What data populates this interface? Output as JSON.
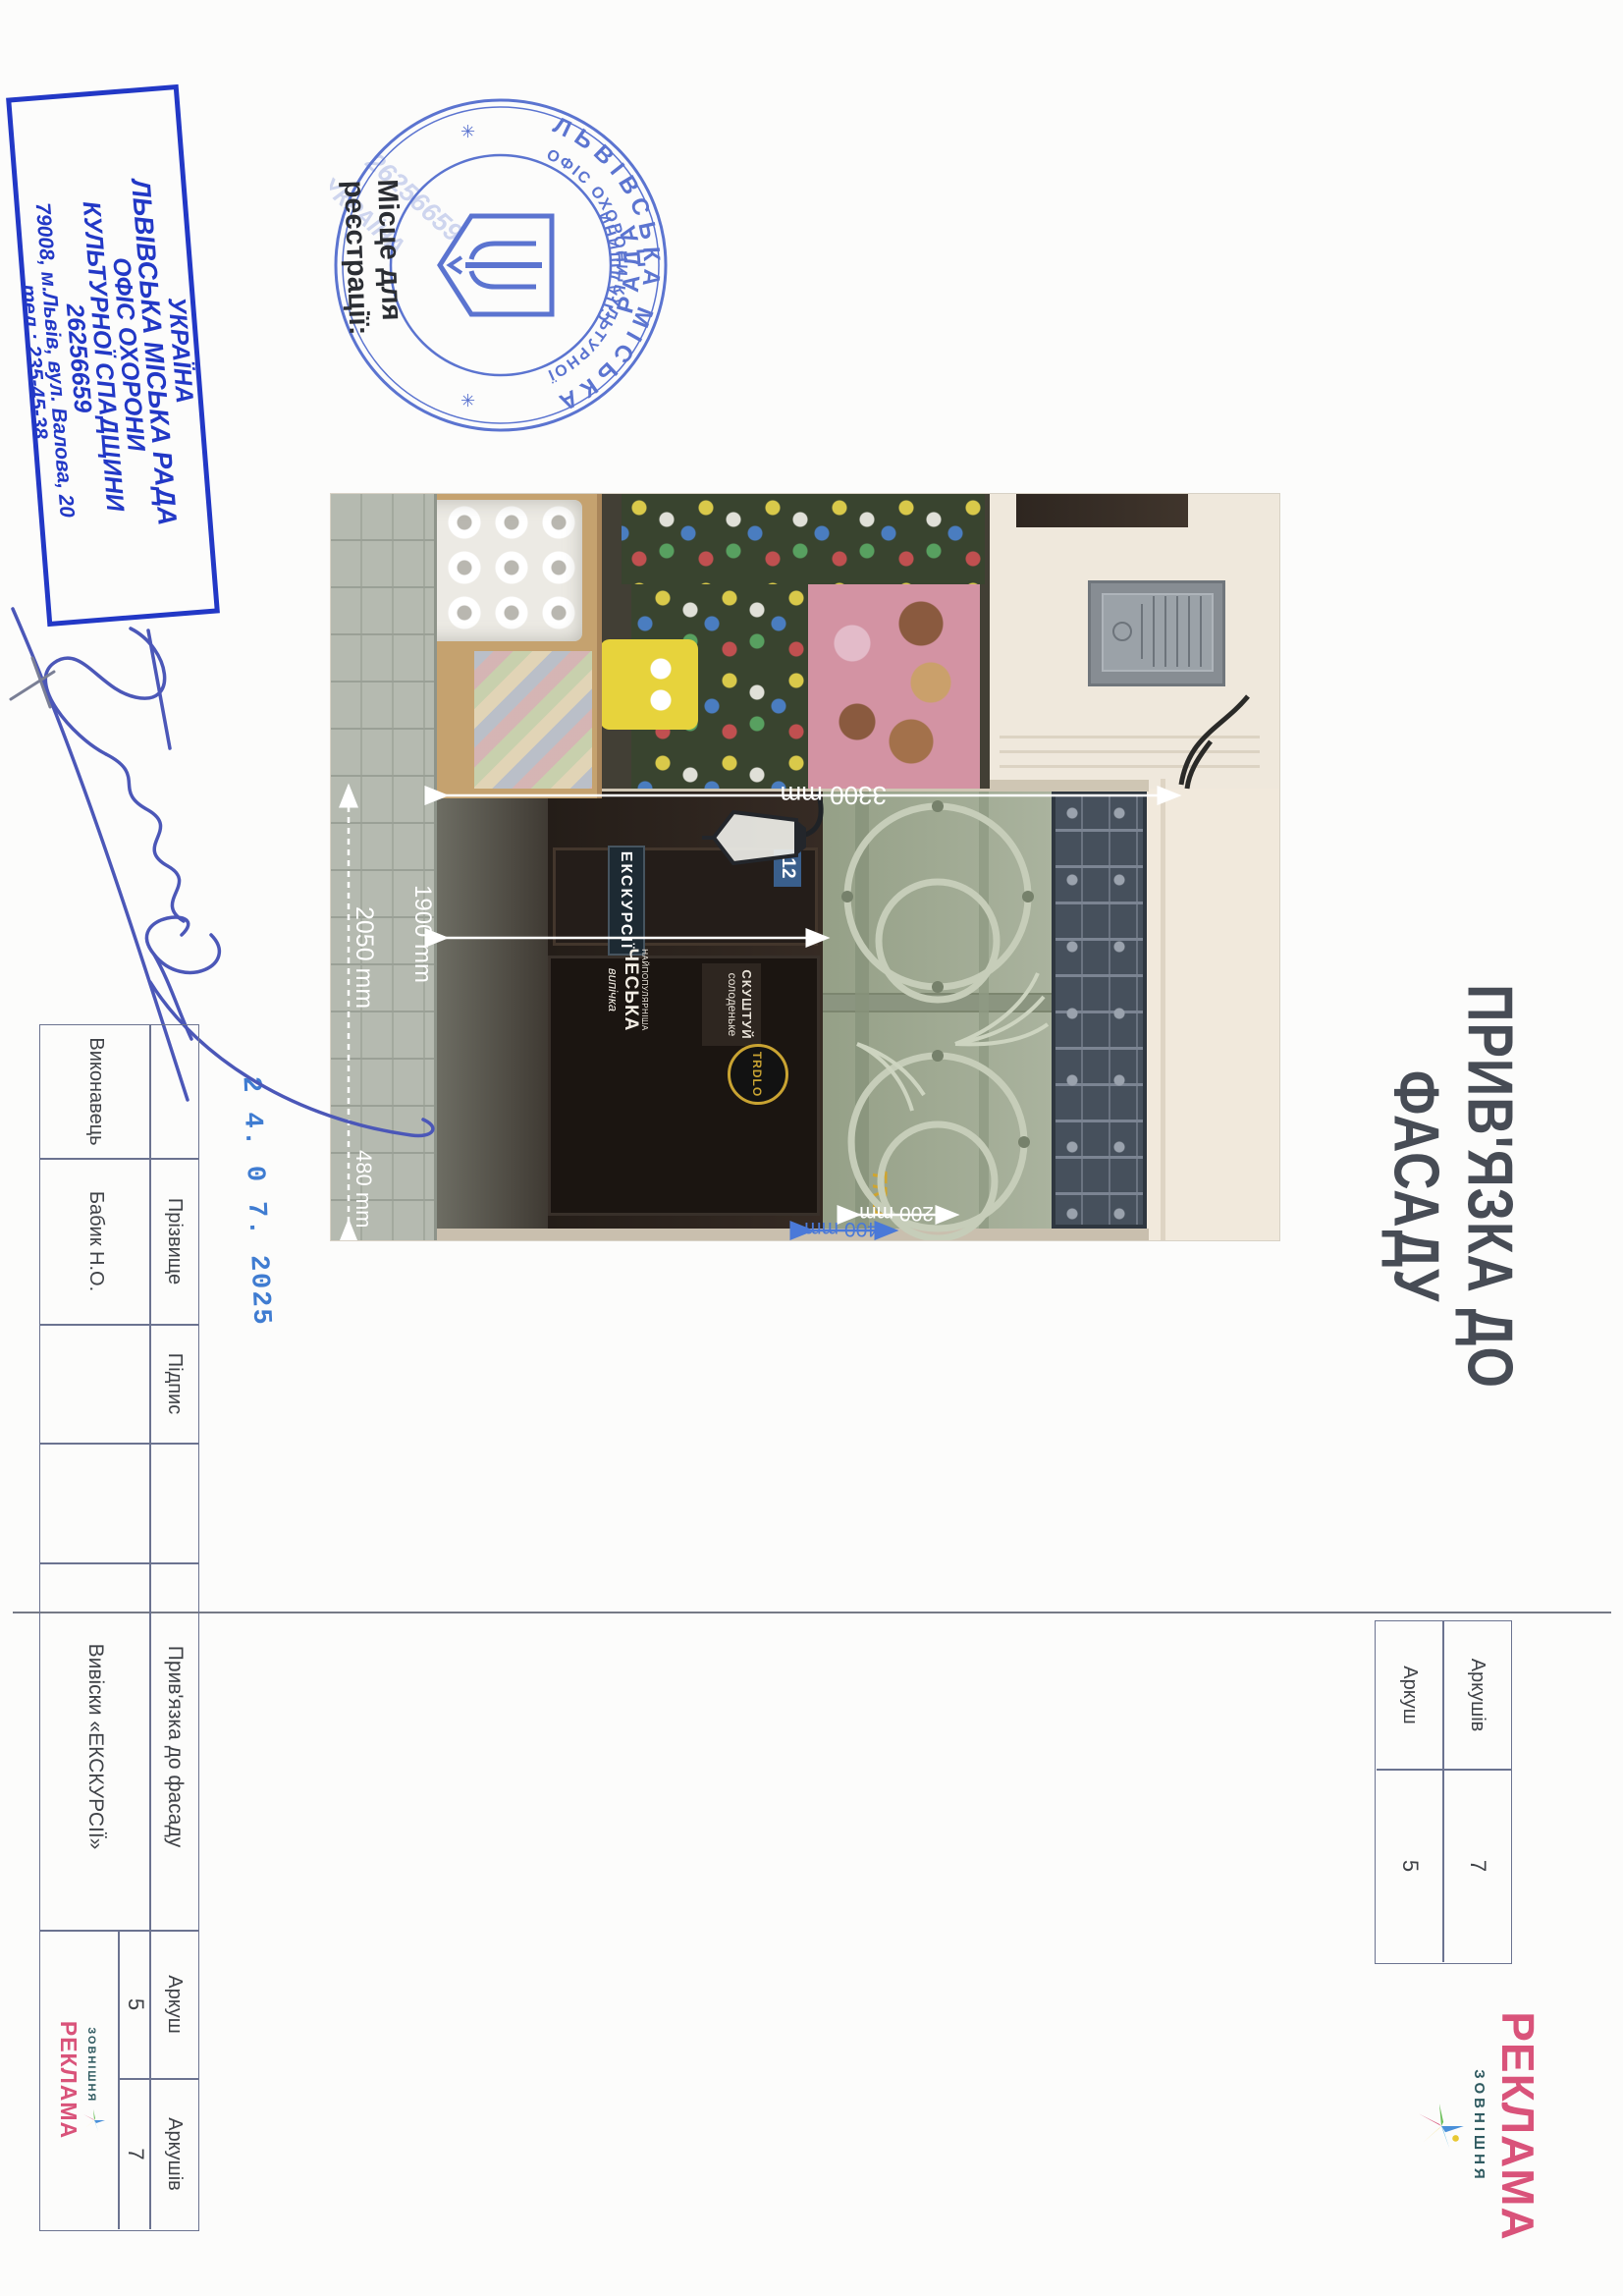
{
  "page": {
    "title": "ПРИВ'ЯЗКА ДО ФАСАДУ"
  },
  "org_stamp": {
    "line1": "УКРАЇНА",
    "line2": "ЛЬВІВСЬКА МІСЬКА РАДА",
    "line3": "ОФІС ОХОРОНИ",
    "line4": "КУЛЬТУРНОЇ СПАДЩИНИ",
    "line5": "26256659",
    "line6": "79008, м.Львів, вул. Валова, 20",
    "line7": "тел.: 235-45-38",
    "color": "#2238c6"
  },
  "seal": {
    "outer_top": "ЛЬВІВСЬКА МІСЬКА",
    "outer_bottom": "РАДА",
    "inner_top": "ОФІС ОХОРОНИ КУЛЬТУРНОЇ",
    "inner_bottom": "СПАДЩИНИ",
    "star_left": "✳",
    "star_right": "✳",
    "ghost_number": "26256659",
    "ghost_country": "УКРАЇНА",
    "color": "#5b74d0"
  },
  "registration_note": {
    "line1": "Місце для",
    "line2": "реєстрації:"
  },
  "date_stamp": {
    "value": "2 4. 0 7. 2025"
  },
  "photo": {
    "dim_gate_height": "3300 mm",
    "dim_gate_width": "2050 mm",
    "dim_pier": "480 mm",
    "dim_offset_white": "200 mm",
    "dim_offset_blue": "400 mm",
    "dim_sign_height": "1900 mm",
    "door_sign": "ЕКСКУРСІЇ",
    "house_number": "12",
    "poster_line1": "СКУШТУЙ",
    "poster_line2": "солоденьке",
    "bakery_line1": "НАЙПОПУЛЯРНІША",
    "bakery_line2": "ЧЕСЬКА",
    "bakery_line3": "випічка",
    "hanging_sign": "TRDLO",
    "gold_letters": "TRD"
  },
  "titleblock": {
    "executor_label": "Виконавець",
    "surname_label": "Прізвище",
    "signature_label": "Підпис",
    "surname_value": "Бабик Н.О.",
    "doc_title": "Прив'язка до фасаду",
    "doc_subject": "Вивіски «ЕКСКУРСІЇ»",
    "sheet_label": "Аркуш",
    "sheets_label": "Аркушів",
    "sheet_value": "5",
    "sheets_value": "7"
  },
  "corner_table": {
    "row1_label": "Аркушів",
    "row1_value": "7",
    "row2_label": "Аркуш",
    "row2_value": "5"
  },
  "logo": {
    "line_top": "ЗОВНІШНЯ",
    "line_bottom": "РЕКЛАМА"
  }
}
